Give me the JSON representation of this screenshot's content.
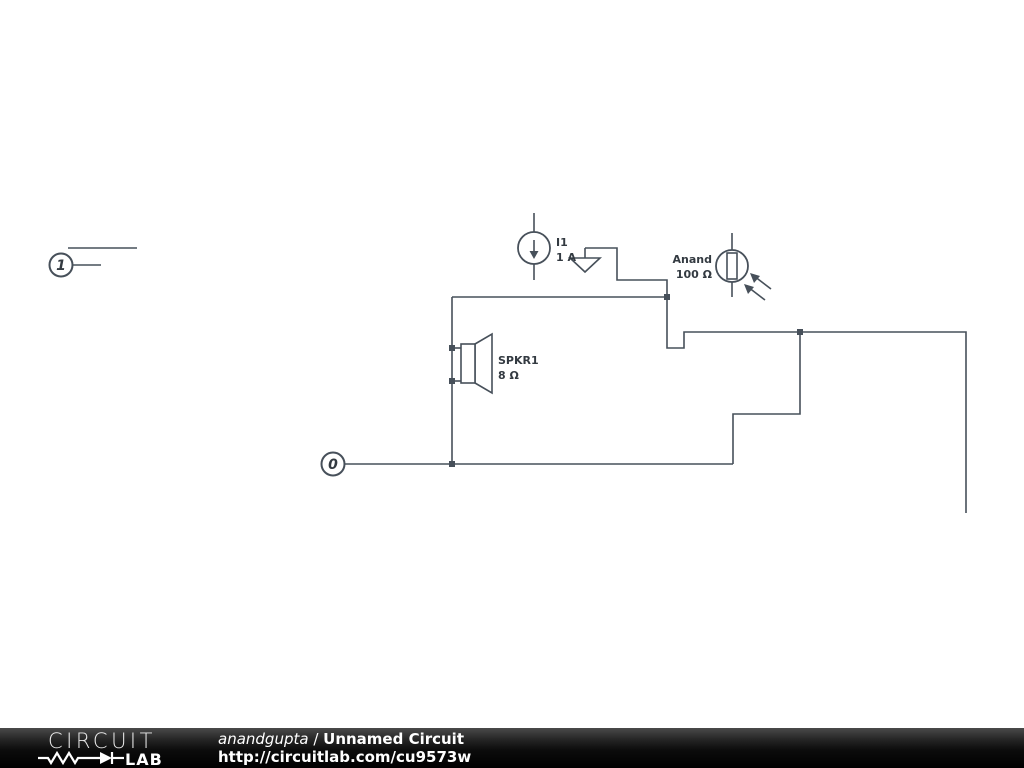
{
  "schematic": {
    "wire_color": "#47505a",
    "label_color": "#333a41",
    "nodes": {
      "node1": "1",
      "node0": "0"
    },
    "current_source": {
      "name": "I1",
      "value": "1 A"
    },
    "photoresistor": {
      "name": "Anand",
      "value": "100 Ω"
    },
    "speaker": {
      "name": "SPKR1",
      "value": "8 Ω"
    }
  },
  "footer": {
    "logo_circuit": "CIRCUIT",
    "logo_lab": "LAB",
    "author": "anandgupta",
    "separator": " / ",
    "title": "Unnamed Circuit",
    "url": "http://circuitlab.com/cu9573w"
  }
}
